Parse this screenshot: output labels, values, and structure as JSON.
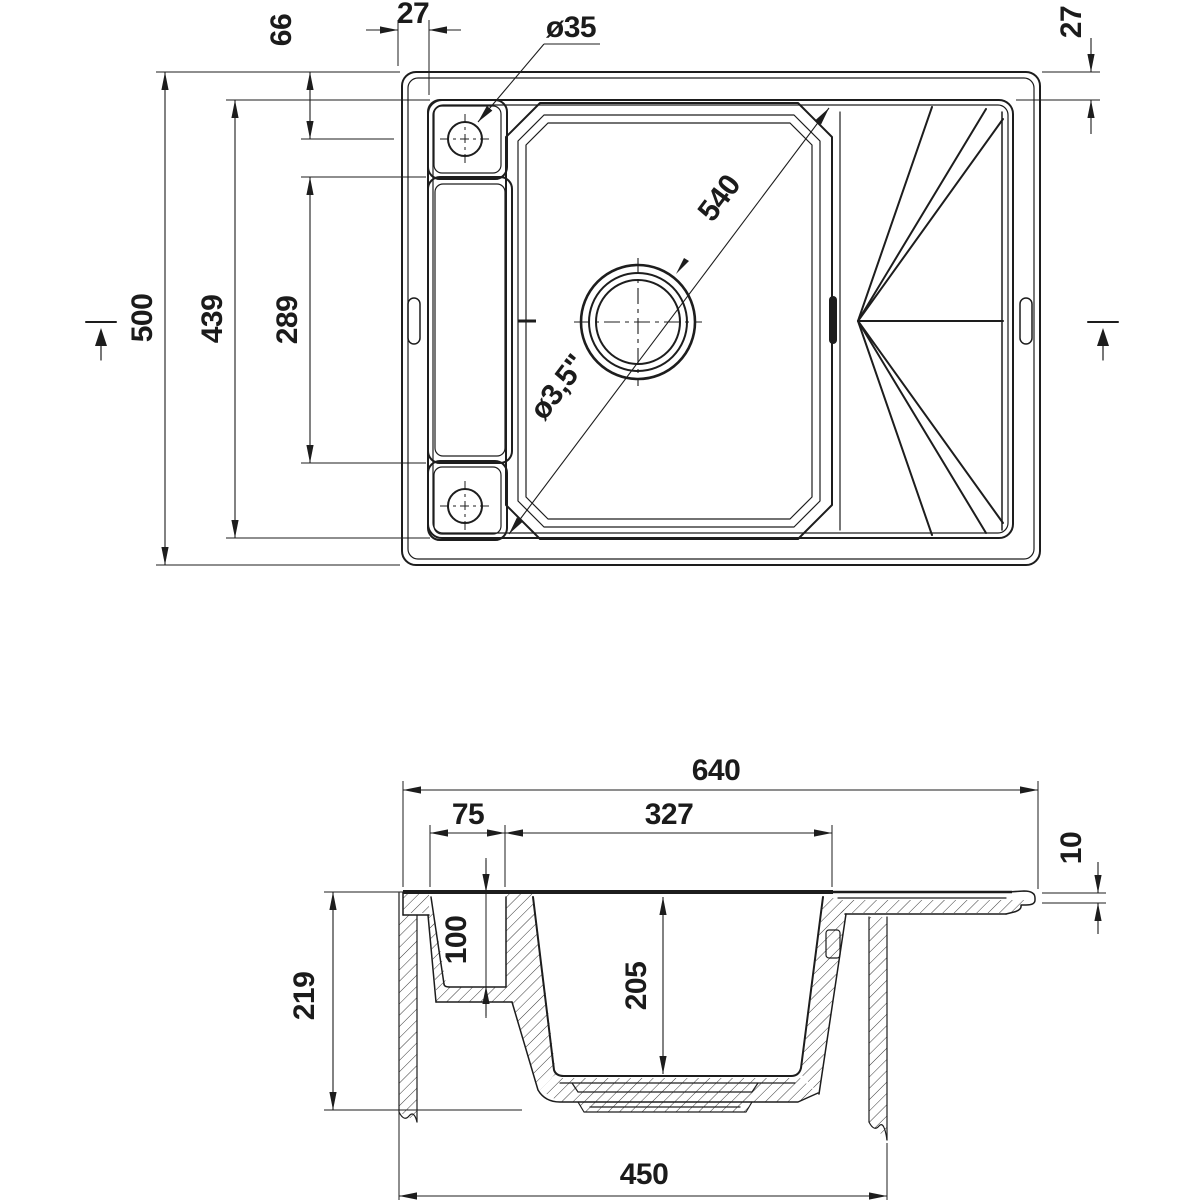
{
  "style": {
    "background": "#ffffff",
    "line_color": "#1d1d1d"
  },
  "views": {
    "top": {
      "dims": {
        "hole_offset": "66",
        "rim_left": "27",
        "rim_right": "27",
        "tap_hole_diameter": "ø35",
        "overall_depth": "500",
        "inner_length": "439",
        "pocket_length": "289",
        "bowl_diagonal": "540",
        "drain_diameter": "ø3,5\""
      }
    },
    "section": {
      "dims": {
        "overall_width": "640",
        "rim_to_bowl": "75",
        "bowl_width": "327",
        "edge_height": "10",
        "pocket_depth": "100",
        "overall_height": "219",
        "bowl_depth": "205",
        "cabinet_width": "450"
      }
    }
  }
}
